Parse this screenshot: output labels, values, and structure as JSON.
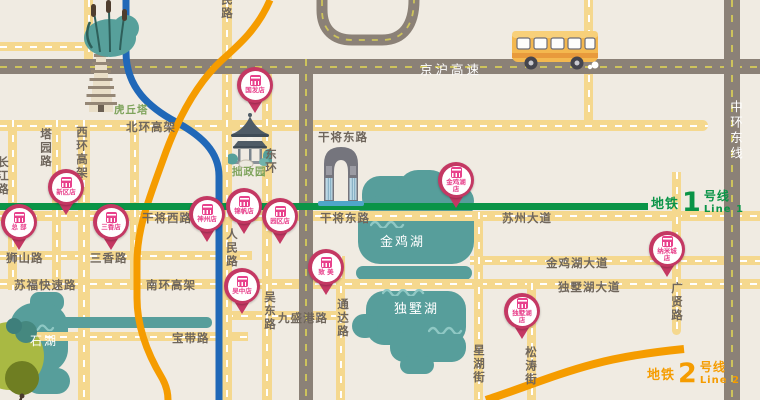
{
  "colors": {
    "background": "#F0EBE2",
    "road_yellow": "#F5D88E",
    "road_dark": "#8B8177",
    "road_dash_white": "#FFFFFF",
    "road_dash_yellow": "#CDC35C",
    "lake_teal": "#579E9B",
    "metro_line1_green": "#0A9447",
    "metro_line2_orange": "#F59C00",
    "metro_blue": "#2068B8",
    "pin_crimson": "#C43863",
    "pin_pink": "#E8418C",
    "label_gray": "#6F665C",
    "label_green": "#7EA35B"
  },
  "icons": [
    "pagoda-icon",
    "pavilion-icon",
    "gate-of-orient-icon",
    "bus-icon",
    "reeds-icon",
    "tree-icon",
    "wave-icon",
    "store-pin-icon"
  ],
  "metro": {
    "line1": {
      "prefix": "地铁",
      "number": "1",
      "suffix": "号线",
      "latin": "Line 1"
    },
    "line2": {
      "prefix": "地铁",
      "number": "2",
      "suffix": "号线",
      "latin": "Line 2"
    }
  },
  "labels": [
    {
      "name": "label-huqiuta",
      "text": "虎丘塔",
      "x": 114,
      "y": 102,
      "cls": "green"
    },
    {
      "name": "label-zhuozhengyuan",
      "text": "拙政园",
      "x": 232,
      "y": 164,
      "cls": "green"
    },
    {
      "name": "label-beihuan-gaojia",
      "text": "北环高架",
      "x": 126,
      "y": 119,
      "cls": "road"
    },
    {
      "name": "label-xihuan-gaojia",
      "text": "西环高架",
      "x": 74,
      "y": 126,
      "cls": "road v"
    },
    {
      "name": "label-tayuan-lu",
      "text": "塔园路",
      "x": 38,
      "y": 128,
      "cls": "road v"
    },
    {
      "name": "label-changjiang-lu",
      "text": "长江路",
      "x": -5,
      "y": 156,
      "cls": "road v"
    },
    {
      "name": "label-renmin-lu-top",
      "text": "人民路",
      "x": 219,
      "y": -20,
      "cls": "road v"
    },
    {
      "name": "label-renmin-lu",
      "text": "人民路",
      "x": 224,
      "y": 228,
      "cls": "road v"
    },
    {
      "name": "label-donghuan",
      "text": "东环",
      "x": 263,
      "y": 148,
      "cls": "road v"
    },
    {
      "name": "label-ganjiang-xilu",
      "text": "干将西路",
      "x": 142,
      "y": 210,
      "cls": "road"
    },
    {
      "name": "label-ganjiang-donglu-upper",
      "text": "干将东路",
      "x": 318,
      "y": 129,
      "cls": "road"
    },
    {
      "name": "label-ganjiang-donglu",
      "text": "干将东路",
      "x": 320,
      "y": 210,
      "cls": "road"
    },
    {
      "name": "label-suzhou-dadao",
      "text": "苏州大道",
      "x": 502,
      "y": 210,
      "cls": "road"
    },
    {
      "name": "label-shishan-lu",
      "text": "狮山路",
      "x": 6,
      "y": 250,
      "cls": "road"
    },
    {
      "name": "label-sanxiang-lu",
      "text": "三香路",
      "x": 90,
      "y": 250,
      "cls": "road"
    },
    {
      "name": "label-sufu-kuaisulu",
      "text": "苏福快速路",
      "x": 14,
      "y": 277,
      "cls": "road"
    },
    {
      "name": "label-nanhuan-gaojia",
      "text": "南环高架",
      "x": 146,
      "y": 277,
      "cls": "road"
    },
    {
      "name": "label-baodai-lu",
      "text": "宝带路",
      "x": 172,
      "y": 330,
      "cls": "road"
    },
    {
      "name": "label-wudong-lu",
      "text": "吴东路",
      "x": 262,
      "y": 291,
      "cls": "road v"
    },
    {
      "name": "label-jiushenggang-lu",
      "text": "九盛港路",
      "x": 278,
      "y": 310,
      "cls": "road"
    },
    {
      "name": "label-tongda-lu",
      "text": "通达路",
      "x": 335,
      "y": 298,
      "cls": "road v"
    },
    {
      "name": "label-xinghu-jie",
      "text": "星湖街",
      "x": 471,
      "y": 344,
      "cls": "road v"
    },
    {
      "name": "label-songtao-jie",
      "text": "松涛街",
      "x": 523,
      "y": 346,
      "cls": "road v"
    },
    {
      "name": "label-guangxian-lu",
      "text": "广贤路",
      "x": 669,
      "y": 282,
      "cls": "road v"
    },
    {
      "name": "label-jinjihu-dadao",
      "text": "金鸡湖大道",
      "x": 546,
      "y": 255,
      "cls": "road"
    },
    {
      "name": "label-dushuhu-dadao",
      "text": "独墅湖大道",
      "x": 558,
      "y": 279,
      "cls": "road"
    },
    {
      "name": "label-jinghu-gaosu",
      "text": "京沪高速",
      "x": 420,
      "y": 59,
      "cls": "hwy"
    },
    {
      "name": "label-zhonghuan-dongxian",
      "text": "中环东线",
      "x": 726,
      "y": 100,
      "cls": "hwy v"
    },
    {
      "name": "label-jinji-lake",
      "text": "金鸡湖",
      "x": 380,
      "y": 231,
      "cls": "lake"
    },
    {
      "name": "label-dushu-lake",
      "text": "独墅湖",
      "x": 394,
      "y": 298,
      "cls": "lake"
    },
    {
      "name": "label-shi-lake",
      "text": "石湖",
      "x": 30,
      "y": 332,
      "cls": "lake sm"
    }
  ],
  "pins": [
    {
      "name": "pin-guofadian",
      "lines": [
        "国发店"
      ],
      "x": 255,
      "y": 85
    },
    {
      "name": "pin-xinqudian",
      "lines": [
        "新区店"
      ],
      "x": 66,
      "y": 187
    },
    {
      "name": "pin-zongbu",
      "lines": [
        "总 部"
      ],
      "x": 19,
      "y": 222
    },
    {
      "name": "pin-sanxiangdian",
      "lines": [
        "三香店"
      ],
      "x": 111,
      "y": 222
    },
    {
      "name": "pin-shenzhoudian",
      "lines": [
        "神州店"
      ],
      "x": 207,
      "y": 214
    },
    {
      "name": "pin-jinfandian",
      "lines": [
        "锦帆店"
      ],
      "x": 244,
      "y": 206
    },
    {
      "name": "pin-yuanqudian",
      "lines": [
        "园区店"
      ],
      "x": 280,
      "y": 216
    },
    {
      "name": "pin-wuzhongdian",
      "lines": [
        "吴中店"
      ],
      "x": 242,
      "y": 286
    },
    {
      "name": "pin-zhimei",
      "lines": [
        "致 美"
      ],
      "x": 326,
      "y": 267
    },
    {
      "name": "pin-jinjihudian",
      "lines": [
        "金鸡湖",
        "店"
      ],
      "x": 456,
      "y": 180
    },
    {
      "name": "pin-namichengdian",
      "lines": [
        "纳米城",
        "店"
      ],
      "x": 667,
      "y": 249
    },
    {
      "name": "pin-dushuhudian",
      "lines": [
        "独墅湖",
        "店"
      ],
      "x": 522,
      "y": 311
    }
  ]
}
